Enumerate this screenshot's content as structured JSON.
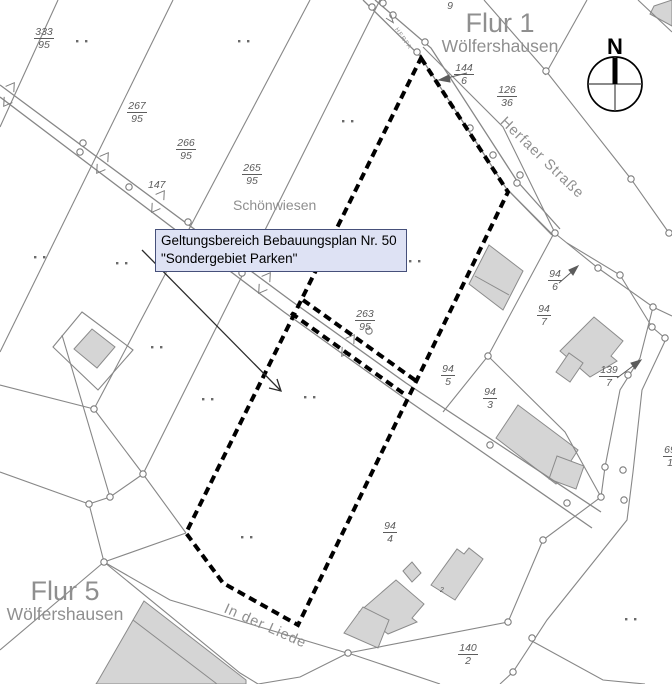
{
  "annotation_box": {
    "line1": "Geltungsbereich Bebauungsplan Nr. 50",
    "line2": "\"Sondergebiet Parken\""
  },
  "north_arrow": {
    "label": "N"
  },
  "district_labels": [
    {
      "flur": "Flur 1",
      "place": "Wölfershausen",
      "x": 430,
      "y": 10,
      "w": 140
    },
    {
      "flur": "Flur 5",
      "place": "Wölfershausen",
      "x": 1,
      "y": 578,
      "w": 128
    }
  ],
  "area_labels": [
    {
      "text": "Schönwiesen",
      "x": 233,
      "y": 197,
      "size": 14,
      "angle": 0,
      "spacing": 0
    },
    {
      "text": "Herfaer Straße",
      "x": 508,
      "y": 114,
      "size": 14.5,
      "angle": 44,
      "spacing": 1
    },
    {
      "text": "In der Liede",
      "x": 228,
      "y": 601,
      "size": 14.5,
      "angle": 24,
      "spacing": 1
    },
    {
      "text": "HERFA",
      "x": 398,
      "y": 27,
      "size": 6,
      "angle": 55,
      "spacing": 1
    }
  ],
  "parcel_labels": [
    {
      "num": "333",
      "den": "95",
      "x": 30,
      "y": 26
    },
    {
      "num": "267",
      "den": "95",
      "x": 123,
      "y": 100
    },
    {
      "num": "266",
      "den": "95",
      "x": 172,
      "y": 137
    },
    {
      "num": "265",
      "den": "95",
      "x": 238,
      "y": 162
    },
    {
      "num": "144",
      "den": "6",
      "x": 450,
      "y": 62
    },
    {
      "num": "126",
      "den": "36",
      "x": 493,
      "y": 84
    },
    {
      "num": "11",
      "den": "9",
      "x": 436,
      "y": -13
    },
    {
      "num": "263",
      "den": "95",
      "x": 351,
      "y": 308
    },
    {
      "num": "94",
      "den": "6",
      "x": 541,
      "y": 268
    },
    {
      "num": "94",
      "den": "7",
      "x": 530,
      "y": 303
    },
    {
      "num": "94",
      "den": "5",
      "x": 434,
      "y": 363
    },
    {
      "num": "94",
      "den": "3",
      "x": 476,
      "y": 386
    },
    {
      "num": "139",
      "den": "7",
      "x": 595,
      "y": 364
    },
    {
      "num": "94",
      "den": "4",
      "x": 376,
      "y": 520
    },
    {
      "num": "140",
      "den": "2",
      "x": 454,
      "y": 642
    },
    {
      "num": "69",
      "den": "1",
      "x": 656,
      "y": 444
    }
  ],
  "text_labels": [
    {
      "text": "147",
      "x": 148,
      "y": 180,
      "size": 10.5
    },
    {
      "text": "95",
      "x": 263,
      "y": 259,
      "size": 10.5
    },
    {
      "text": "2",
      "x": 440,
      "y": 587,
      "size": 7
    }
  ],
  "colors": {
    "background": "#ffffff",
    "line_gray": "#878787",
    "building_fill": "#d5d5d5",
    "building_stroke": "#8b8b8b",
    "boundary_black": "#000000",
    "parcel_label_gray": "#5c5c5c",
    "district_label_gray": "#8f8f8f",
    "annotation_fill": "#dee2f4",
    "annotation_border": "#46507a"
  }
}
